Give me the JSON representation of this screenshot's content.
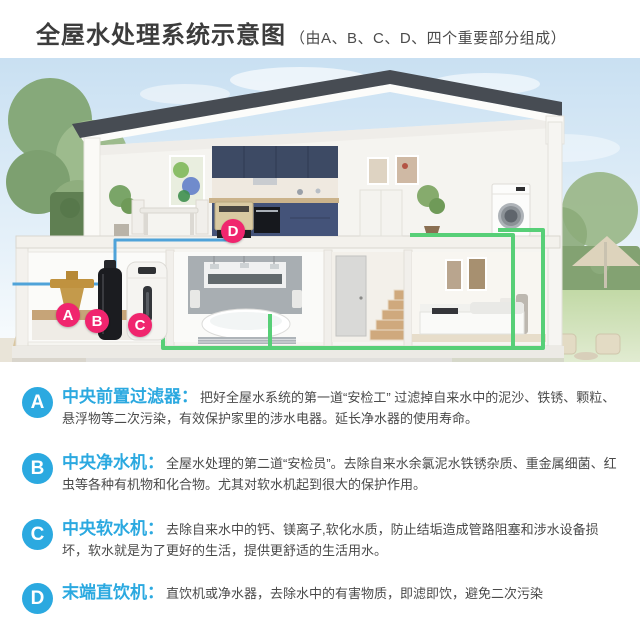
{
  "header": {
    "title": "全屋水处理系统示意图",
    "subtitle": "（由A、B、C、D、四个重要部分组成）"
  },
  "diagram": {
    "markers": [
      {
        "letter": "A"
      },
      {
        "letter": "B"
      },
      {
        "letter": "C"
      },
      {
        "letter": "D"
      }
    ]
  },
  "sections": [
    {
      "letter": "A",
      "title": "中央前置过滤器：",
      "body": "把好全屋水系统的第一道“安检工” 过滤掉自来水中的泥沙、铁锈、颗粒、悬浮物等二次污染，有效保护家里的涉水电器。延长净水器的使用寿命。"
    },
    {
      "letter": "B",
      "title": "中央净水机：",
      "body": "全屋水处理的第二道“安检员”。去除自来水余氯泥水铁锈杂质、重金属细菌、红虫等各种有机物和化合物。尤其对软水机起到很大的保护作用。"
    },
    {
      "letter": "C",
      "title": "中央软水机：",
      "body": "去除自来水中的钙、镁离子,软化水质，防止结垢造成管路阻塞和涉水设备损坏，软水就是为了更好的生活，提供更舒适的生活用水。"
    },
    {
      "letter": "D",
      "title": "末端直饮机：",
      "body": "直饮机或净水器，去除水中的有害物质，即滤即饮，避免二次污染"
    }
  ],
  "colors": {
    "accent_blue": "#2ba9e0",
    "marker_pink": "#f0256e",
    "pipe_blue": "#4fa3d9",
    "pipe_green": "#57cf77",
    "roof_gray": "#474c53",
    "cabinet_navy": "#3d4a64"
  }
}
